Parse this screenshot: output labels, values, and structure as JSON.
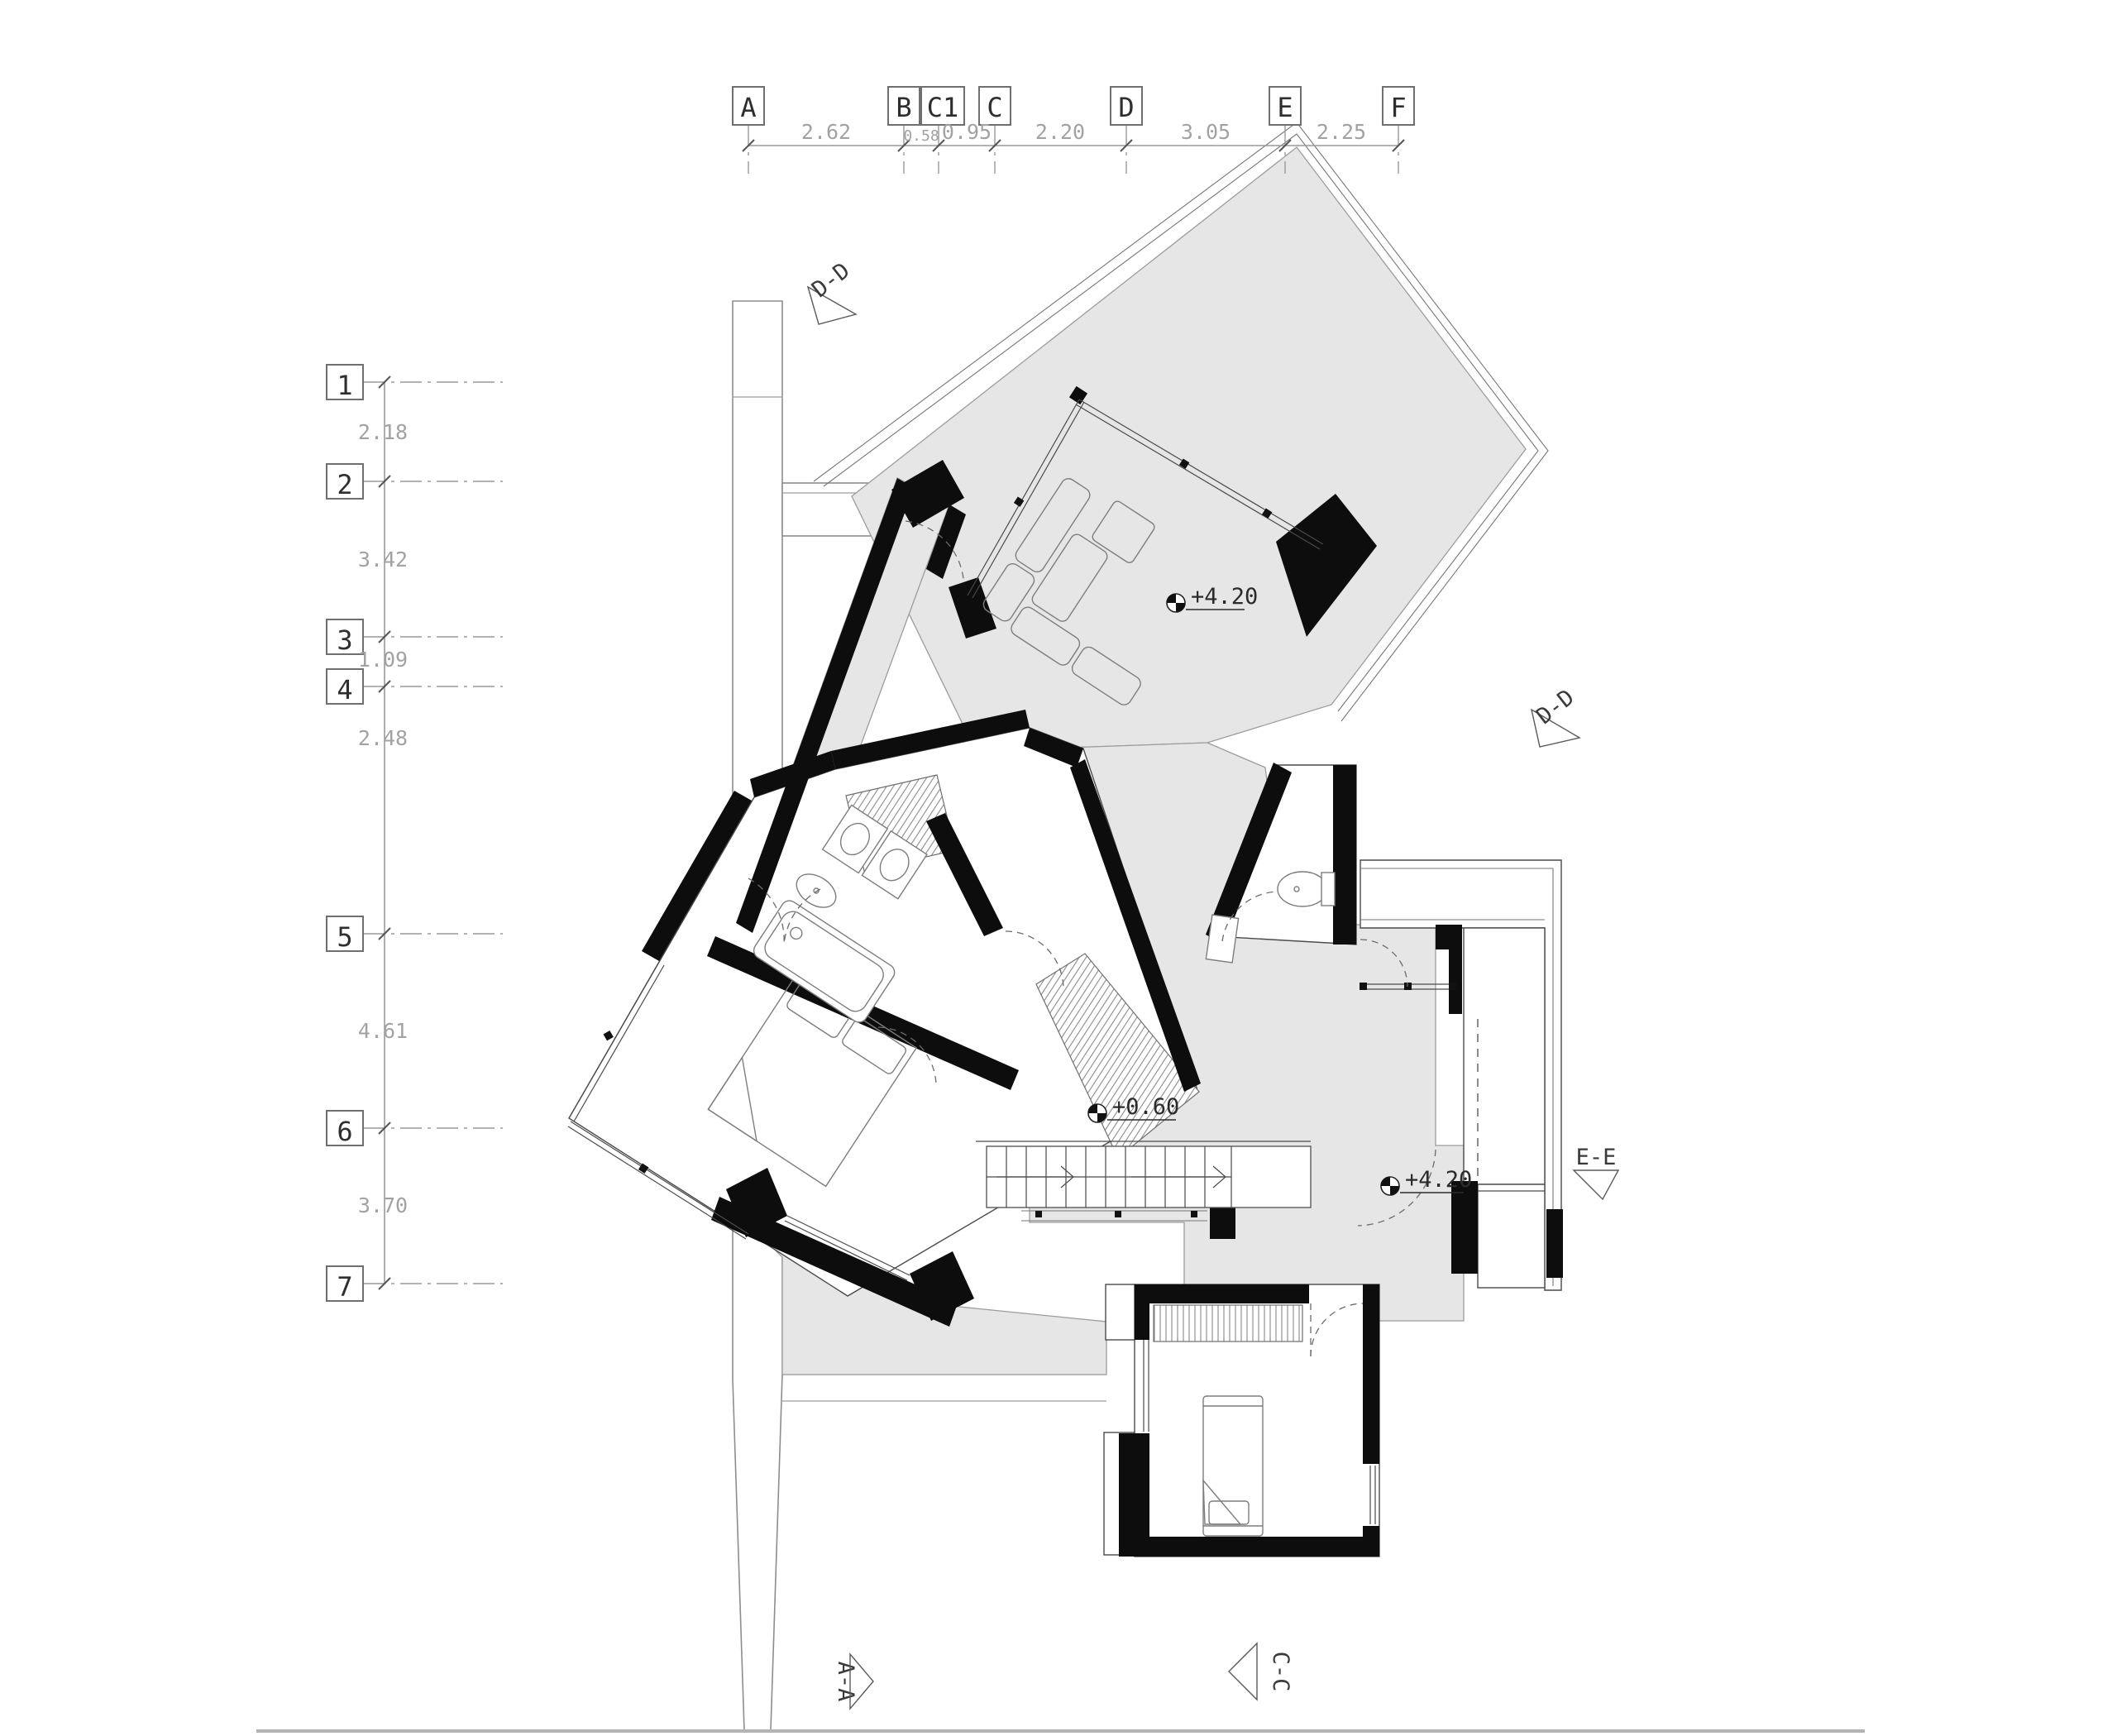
{
  "grid": {
    "columns": [
      {
        "label": "A"
      },
      {
        "label": "B"
      },
      {
        "label": "C1"
      },
      {
        "label": "C"
      },
      {
        "label": "D"
      },
      {
        "label": "E"
      },
      {
        "label": "F"
      }
    ],
    "column_dims": [
      "2.62",
      "0.58",
      "0.95",
      "2.20",
      "3.05",
      "2.25"
    ],
    "rows": [
      {
        "label": "1"
      },
      {
        "label": "2"
      },
      {
        "label": "3"
      },
      {
        "label": "4"
      },
      {
        "label": "5"
      },
      {
        "label": "6"
      },
      {
        "label": "7"
      }
    ],
    "row_dims": [
      "2.18",
      "3.42",
      "1.09",
      "2.48",
      "4.61",
      "3.70"
    ]
  },
  "levels": [
    {
      "label": "+4.20"
    },
    {
      "label": "+0.60"
    },
    {
      "label": "+4.20"
    }
  ],
  "sections": [
    {
      "label": "D-D"
    },
    {
      "label": "D-D"
    },
    {
      "label": "E-E"
    },
    {
      "label": "A-A"
    },
    {
      "label": "C-C"
    }
  ],
  "colors": {
    "paper": "#ffffff",
    "floor_grey": "#e6e6e6",
    "wall_black": "#0d0d0d",
    "dim_grey": "#a2a2a2"
  }
}
